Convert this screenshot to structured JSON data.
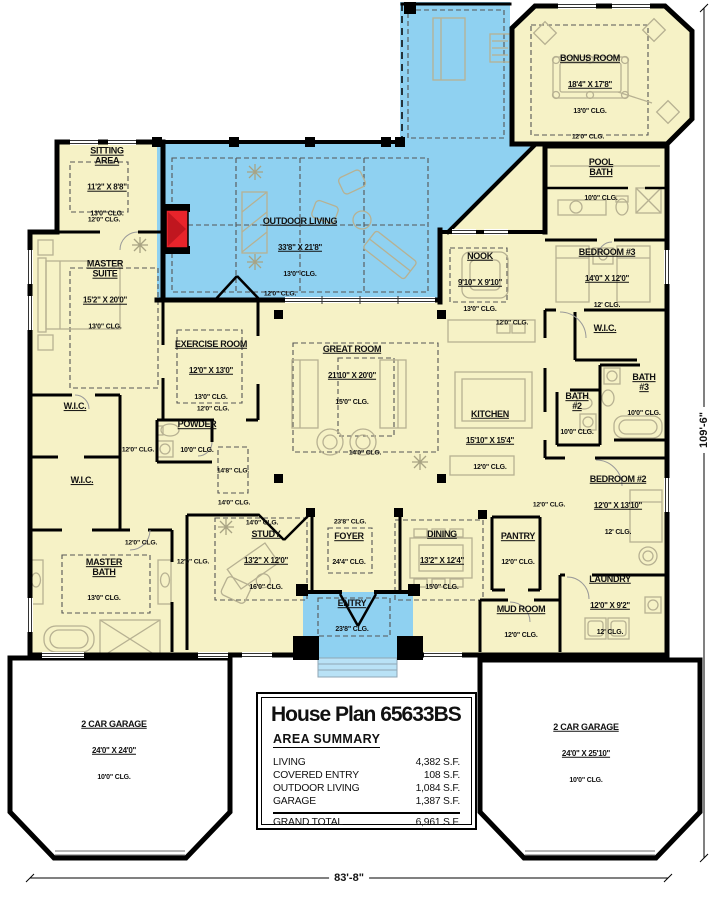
{
  "title_block": {
    "title": "House Plan 65633BS",
    "heading": "AREA SUMMARY",
    "rows": [
      {
        "label": "LIVING",
        "value": "4,382 S.F."
      },
      {
        "label": "COVERED ENTRY",
        "value": "108 S.F."
      },
      {
        "label": "OUTDOOR LIVING",
        "value": "1,084 S.F."
      },
      {
        "label": "GARAGE",
        "value": "1,387 S.F."
      }
    ],
    "total": {
      "label": "GRAND TOTAL",
      "value": "6,961 S.F."
    }
  },
  "dimensions": {
    "width_label": "83'-8\"",
    "height_label": "109'-6\""
  },
  "clg_notes": {
    "c12": "12'0\" CLG.",
    "c14": "14'0\" CLG.",
    "c148": "14'8\" CLG.",
    "c238": "23'8\" CLG."
  },
  "rooms": {
    "sitting": {
      "name": "SITTING\nAREA",
      "dims": "11'2\" X 8'8\"",
      "clg": "13'0\" CLG."
    },
    "master_suite": {
      "name": "MASTER\nSUITE",
      "dims": "15'2\" X 20'0\"",
      "clg": "13'0\" CLG."
    },
    "outdoor_living": {
      "name": "OUTDOOR LIVING",
      "dims": "33'8\" X 21'8\"",
      "clg": "13'0\" CLG."
    },
    "bonus_room": {
      "name": "BONUS ROOM",
      "dims": "18'4\" X 17'8\"",
      "clg": "13'0\" CLG."
    },
    "pool_bath": {
      "name": "POOL\nBATH",
      "clg": "10'0\" CLG."
    },
    "bedroom3": {
      "name": "BEDROOM #3",
      "dims": "14'0\" X 12'0\"",
      "clg": "12' CLG."
    },
    "nook": {
      "name": "NOOK",
      "dims": "9'10\" X 9'10\"",
      "clg": "13'0\" CLG."
    },
    "exercise": {
      "name": "EXERCISE ROOM",
      "dims": "12'0\" X 13'0\"",
      "clg": "13'0\" CLG."
    },
    "great_room": {
      "name": "GREAT ROOM",
      "dims": "21'10\" X 20'0\"",
      "clg": "15'0\" CLG."
    },
    "kitchen": {
      "name": "KITCHEN",
      "dims": "15'10\" X 15'4\"",
      "clg": "12'0\" CLG."
    },
    "wic_right": {
      "name": "W.I.C."
    },
    "wic_upper": {
      "name": "W.I.C."
    },
    "wic_lower": {
      "name": "W.I.C."
    },
    "powder": {
      "name": "POWDER",
      "clg": "10'0\" CLG."
    },
    "bath2": {
      "name": "BATH\n#2",
      "clg": "10'0\" CLG."
    },
    "bath3": {
      "name": "BATH\n#3",
      "clg": "10'0\" CLG."
    },
    "master_bath": {
      "name": "MASTER\nBATH",
      "clg": "13'0\" CLG."
    },
    "study": {
      "name": "STUDY",
      "dims": "13'2\" X 12'0\"",
      "clg": "16'0\" CLG."
    },
    "foyer": {
      "name": "FOYER",
      "clg": "24'4\" CLG."
    },
    "dining": {
      "name": "DINING",
      "dims": "13'2\" X 12'4\"",
      "clg": "15'0\" CLG."
    },
    "entry": {
      "name": "ENTRY",
      "clg": "23'8\" CLG."
    },
    "pantry": {
      "name": "PANTRY",
      "clg": "12'0\" CLG."
    },
    "mud_room": {
      "name": "MUD ROOM",
      "clg": "12'0\" CLG."
    },
    "laundry": {
      "name": "LAUNDRY",
      "dims": "12'0\" X 9'2\"",
      "clg": "12' CLG."
    },
    "bedroom2": {
      "name": "BEDROOM #2",
      "dims": "12'0\" X 13'10\"",
      "clg": "12' CLG."
    },
    "garage_left": {
      "name": "2 CAR GARAGE",
      "dims": "24'0\" X 24'0\"",
      "clg": "10'0\" CLG."
    },
    "garage_right": {
      "name": "2 CAR GARAGE",
      "dims": "24'0\" X 25'10\"",
      "clg": "10'0\" CLG."
    }
  },
  "colors": {
    "room_fill": "#f6f2c6",
    "outdoor_fill": "#8fd1f1",
    "fireplace_red": "#e8242b",
    "wall": "#000000",
    "furniture_line": "#b7b192"
  }
}
